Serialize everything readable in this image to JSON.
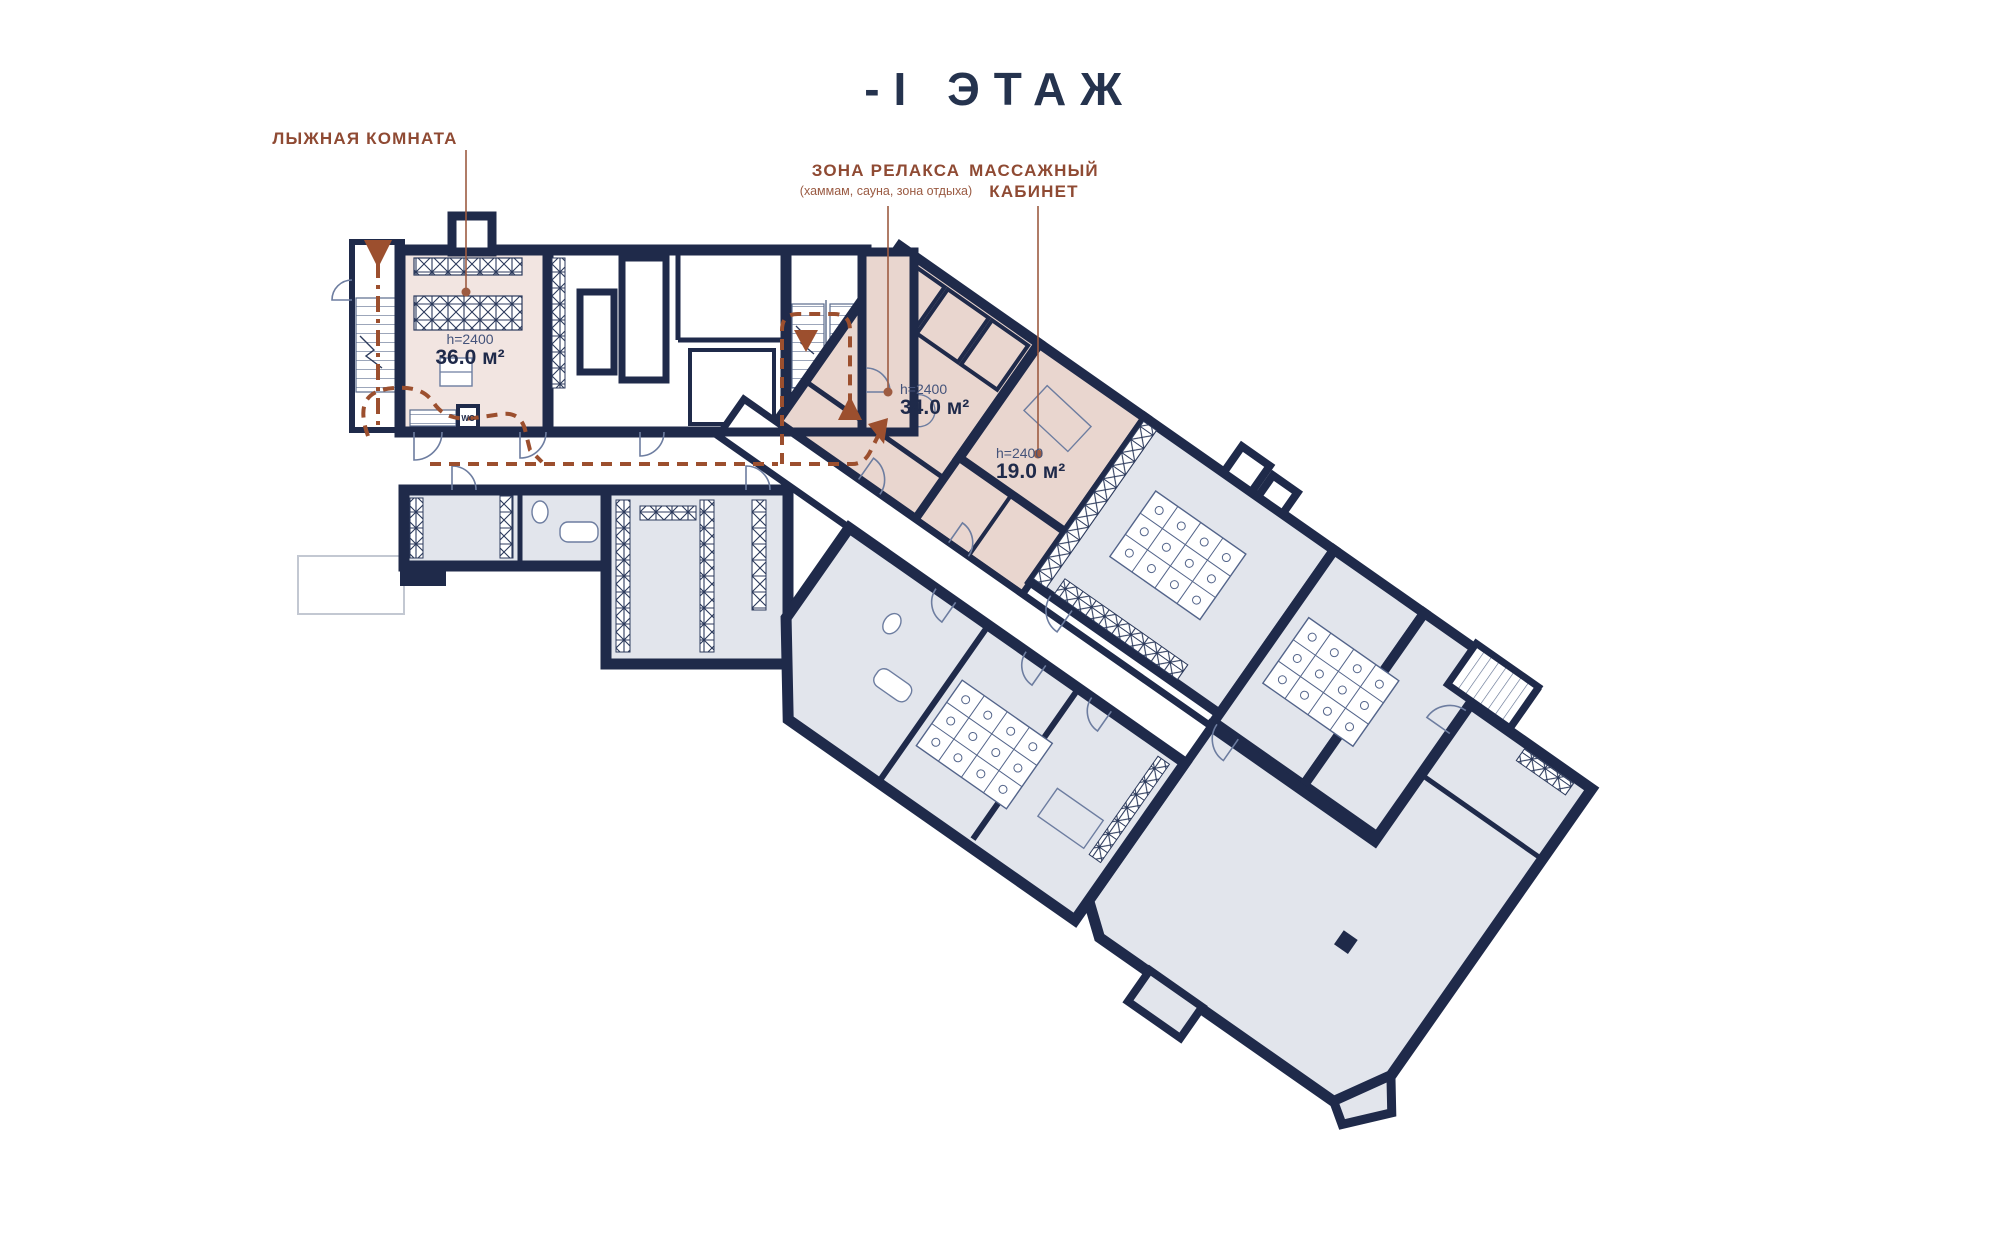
{
  "title": "-I  ЭТАЖ",
  "legend": {
    "ski_room": {
      "label": "ЛЫЖНАЯ КОМНАТА"
    },
    "relax_zone": {
      "label": "ЗОНА РЕЛАКСА",
      "sublabel": "(хаммам, сауна, зона отдыха)"
    },
    "massage": {
      "label": "МАССАЖНЫЙ",
      "label_line2": "КАБИНЕТ"
    }
  },
  "rooms": {
    "ski_room": {
      "ceiling_height": "h=2400",
      "area": "36.0 м²"
    },
    "relax_zone": {
      "ceiling_height": "h=2400",
      "area": "34.0 м²"
    },
    "massage": {
      "ceiling_height": "h=2400",
      "area": "19.0 м²"
    }
  },
  "fixtures": {
    "wc_label": "WC"
  },
  "colors": {
    "wall_navy": "#1f2a4a",
    "room_gray": "#e2e5ec",
    "room_pink_light": "#f2e5e1",
    "room_pink": "#e9d6cf",
    "label_brown": "#8f4a33",
    "route_brown": "#9c4f2e",
    "thin_line": "#6d7da0"
  }
}
